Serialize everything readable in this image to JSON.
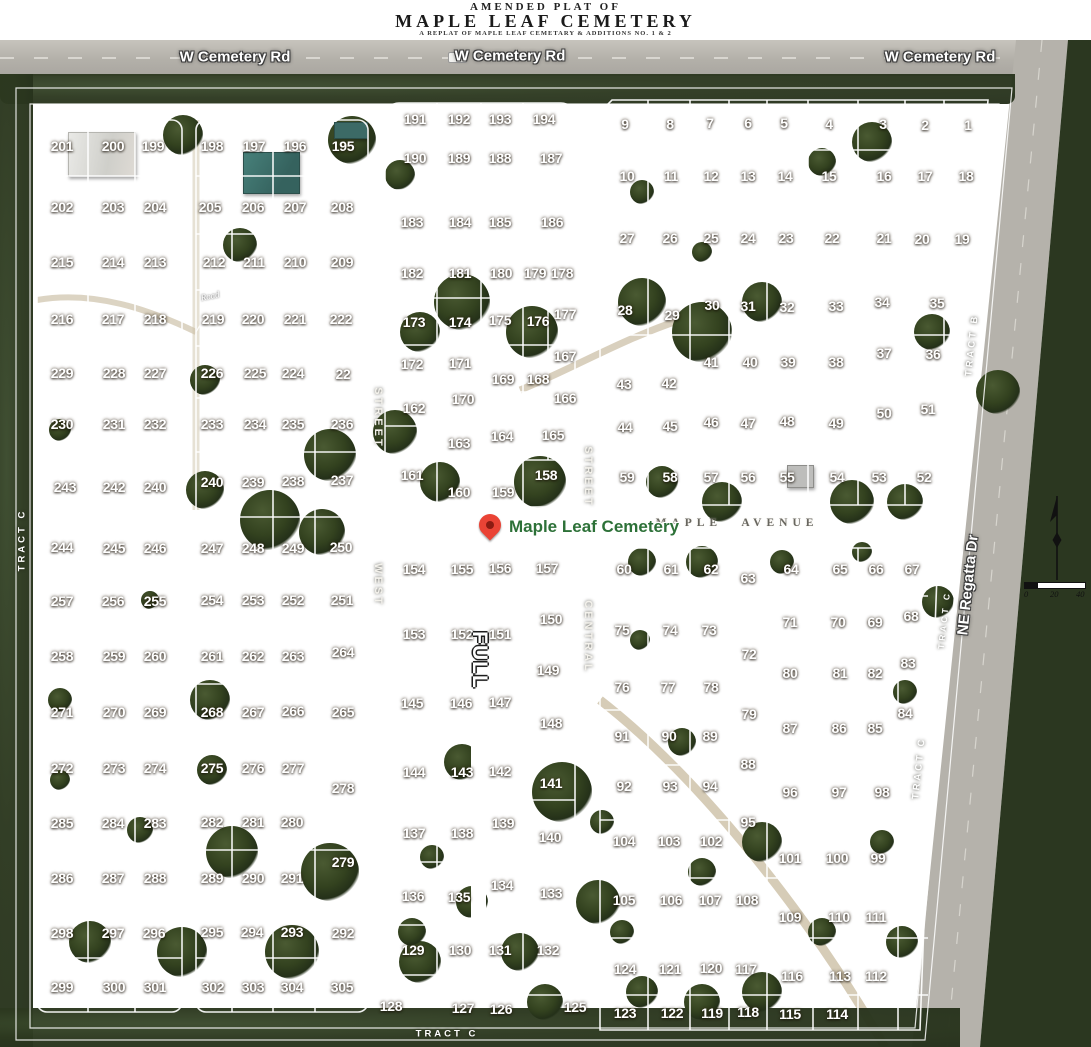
{
  "title": {
    "line1": "AMENDED PLAT OF",
    "line2": "MAPLE LEAF CEMETERY",
    "line3": "A REPLAT OF MAPLE LEAF CEMETARY & ADDITIONS NO. 1 & 2"
  },
  "roads": {
    "cemetery_rd": [
      "W Cemetery Rd",
      "W Cemetery Rd",
      "W Cemetery Rd"
    ],
    "regatta": "NE Regatta Dr",
    "road_small": "Road"
  },
  "streets": {
    "west": "WEST",
    "west_street": "STREET",
    "central": "CENTRAL",
    "central_street": "STREET",
    "full": "FULL",
    "maple_avenue": "MAPLE AVENUE"
  },
  "tracts": {
    "left": "TRACT  C",
    "bottom": "TRACT   C",
    "right_b": "TRACT  B",
    "right_c1": "TRACT  C",
    "right_c2": "TRACT  C"
  },
  "marker": {
    "label": "Maple Leaf Cemetery",
    "pin_color": "#ea4335",
    "label_color": "#2d7138"
  },
  "scale_bar": {
    "ticks": [
      "0",
      "20",
      "40"
    ]
  },
  "colors": {
    "ground": "#a08862",
    "tree": "#2c381f",
    "plat_line": "#ffffff",
    "road": "#b3b0a9"
  },
  "plots": [
    [
      201,
      62,
      146
    ],
    [
      200,
      113,
      146
    ],
    [
      199,
      153,
      146
    ],
    [
      198,
      212,
      146
    ],
    [
      197,
      254,
      146
    ],
    [
      196,
      295,
      146
    ],
    [
      195,
      343,
      146
    ],
    [
      202,
      62,
      207
    ],
    [
      203,
      113,
      207
    ],
    [
      204,
      155,
      207
    ],
    [
      205,
      210,
      207
    ],
    [
      206,
      253,
      207
    ],
    [
      207,
      295,
      207
    ],
    [
      208,
      342,
      207
    ],
    [
      215,
      62,
      262
    ],
    [
      214,
      113,
      262
    ],
    [
      213,
      155,
      262
    ],
    [
      212,
      214,
      262
    ],
    [
      211,
      254,
      262
    ],
    [
      210,
      295,
      262
    ],
    [
      209,
      342,
      262
    ],
    [
      216,
      62,
      319
    ],
    [
      217,
      113,
      319
    ],
    [
      218,
      155,
      319
    ],
    [
      219,
      213,
      319
    ],
    [
      220,
      253,
      319
    ],
    [
      221,
      295,
      319
    ],
    [
      222,
      341,
      319
    ],
    [
      229,
      62,
      373
    ],
    [
      228,
      114,
      373
    ],
    [
      227,
      155,
      373
    ],
    [
      226,
      212,
      373
    ],
    [
      225,
      255,
      373
    ],
    [
      224,
      293,
      373
    ],
    [
      22,
      343,
      374
    ],
    [
      230,
      62,
      424
    ],
    [
      231,
      114,
      424
    ],
    [
      232,
      155,
      424
    ],
    [
      233,
      212,
      424
    ],
    [
      234,
      255,
      424
    ],
    [
      235,
      293,
      424
    ],
    [
      236,
      342,
      424
    ],
    [
      243,
      65,
      487
    ],
    [
      242,
      114,
      487
    ],
    [
      240,
      155,
      487
    ],
    [
      240,
      212,
      482
    ],
    [
      239,
      253,
      482
    ],
    [
      238,
      293,
      481
    ],
    [
      237,
      342,
      480
    ],
    [
      244,
      62,
      547
    ],
    [
      245,
      114,
      548
    ],
    [
      246,
      155,
      548
    ],
    [
      247,
      212,
      548
    ],
    [
      248,
      253,
      548
    ],
    [
      249,
      293,
      548
    ],
    [
      250,
      341,
      547
    ],
    [
      257,
      62,
      601
    ],
    [
      256,
      113,
      601
    ],
    [
      255,
      155,
      601
    ],
    [
      254,
      212,
      600
    ],
    [
      253,
      253,
      600
    ],
    [
      252,
      293,
      600
    ],
    [
      251,
      342,
      600
    ],
    [
      258,
      62,
      656
    ],
    [
      259,
      114,
      656
    ],
    [
      260,
      155,
      656
    ],
    [
      261,
      212,
      656
    ],
    [
      262,
      253,
      656
    ],
    [
      263,
      293,
      656
    ],
    [
      264,
      343,
      652
    ],
    [
      271,
      62,
      712
    ],
    [
      270,
      114,
      712
    ],
    [
      269,
      155,
      712
    ],
    [
      268,
      212,
      712
    ],
    [
      267,
      253,
      712
    ],
    [
      266,
      293,
      711
    ],
    [
      265,
      343,
      712
    ],
    [
      272,
      62,
      768
    ],
    [
      273,
      114,
      768
    ],
    [
      274,
      155,
      768
    ],
    [
      275,
      212,
      768
    ],
    [
      276,
      253,
      768
    ],
    [
      277,
      293,
      768
    ],
    [
      278,
      343,
      788
    ],
    [
      285,
      62,
      823
    ],
    [
      284,
      113,
      823
    ],
    [
      283,
      155,
      823
    ],
    [
      282,
      212,
      822
    ],
    [
      281,
      253,
      822
    ],
    [
      280,
      292,
      822
    ],
    [
      279,
      343,
      862
    ],
    [
      286,
      62,
      878
    ],
    [
      287,
      113,
      878
    ],
    [
      288,
      155,
      878
    ],
    [
      289,
      212,
      878
    ],
    [
      290,
      253,
      878
    ],
    [
      291,
      292,
      878
    ],
    [
      298,
      62,
      933
    ],
    [
      297,
      113,
      933
    ],
    [
      296,
      154,
      933
    ],
    [
      295,
      212,
      932
    ],
    [
      294,
      252,
      932
    ],
    [
      293,
      292,
      932
    ],
    [
      292,
      343,
      933
    ],
    [
      299,
      62,
      987
    ],
    [
      300,
      114,
      987
    ],
    [
      301,
      155,
      987
    ],
    [
      302,
      213,
      987
    ],
    [
      303,
      253,
      987
    ],
    [
      304,
      292,
      987
    ],
    [
      305,
      342,
      987
    ],
    [
      191,
      415,
      119
    ],
    [
      192,
      459,
      119
    ],
    [
      193,
      500,
      119
    ],
    [
      194,
      544,
      119
    ],
    [
      190,
      415,
      158
    ],
    [
      189,
      459,
      158
    ],
    [
      188,
      500,
      158
    ],
    [
      187,
      551,
      158
    ],
    [
      183,
      412,
      222
    ],
    [
      184,
      460,
      222
    ],
    [
      185,
      500,
      222
    ],
    [
      186,
      552,
      222
    ],
    [
      182,
      412,
      273
    ],
    [
      181,
      460,
      273
    ],
    [
      180,
      501,
      273
    ],
    [
      179,
      535,
      273
    ],
    [
      178,
      562,
      273
    ],
    [
      173,
      414,
      322
    ],
    [
      174,
      460,
      322
    ],
    [
      175,
      500,
      320
    ],
    [
      176,
      538,
      321
    ],
    [
      177,
      565,
      314
    ],
    [
      172,
      412,
      364
    ],
    [
      171,
      460,
      363
    ],
    [
      167,
      565,
      356
    ],
    [
      169,
      503,
      379
    ],
    [
      168,
      538,
      379
    ],
    [
      170,
      463,
      399
    ],
    [
      166,
      565,
      398
    ],
    [
      162,
      414,
      408
    ],
    [
      163,
      459,
      443
    ],
    [
      164,
      502,
      436
    ],
    [
      165,
      553,
      435
    ],
    [
      161,
      412,
      475
    ],
    [
      158,
      546,
      475
    ],
    [
      160,
      459,
      492
    ],
    [
      159,
      503,
      492
    ],
    [
      9,
      625,
      124
    ],
    [
      8,
      670,
      124
    ],
    [
      7,
      710,
      123
    ],
    [
      6,
      748,
      123
    ],
    [
      5,
      784,
      123
    ],
    [
      4,
      829,
      124
    ],
    [
      3,
      883,
      124
    ],
    [
      2,
      925,
      125
    ],
    [
      1,
      968,
      125
    ],
    [
      10,
      627,
      176
    ],
    [
      11,
      671,
      176
    ],
    [
      12,
      711,
      176
    ],
    [
      13,
      748,
      176
    ],
    [
      14,
      785,
      176
    ],
    [
      15,
      829,
      176
    ],
    [
      16,
      884,
      176
    ],
    [
      17,
      925,
      176
    ],
    [
      18,
      966,
      176
    ],
    [
      27,
      627,
      238
    ],
    [
      26,
      670,
      238
    ],
    [
      25,
      711,
      238
    ],
    [
      24,
      748,
      238
    ],
    [
      23,
      786,
      238
    ],
    [
      22,
      832,
      238
    ],
    [
      21,
      884,
      238
    ],
    [
      20,
      922,
      239
    ],
    [
      19,
      962,
      239
    ],
    [
      28,
      625,
      310
    ],
    [
      29,
      672,
      315
    ],
    [
      30,
      712,
      305
    ],
    [
      31,
      748,
      306
    ],
    [
      32,
      787,
      307
    ],
    [
      33,
      836,
      306
    ],
    [
      34,
      882,
      302
    ],
    [
      35,
      937,
      303
    ],
    [
      43,
      624,
      384
    ],
    [
      42,
      669,
      383
    ],
    [
      41,
      711,
      362
    ],
    [
      40,
      750,
      362
    ],
    [
      39,
      788,
      362
    ],
    [
      38,
      836,
      362
    ],
    [
      37,
      884,
      353
    ],
    [
      36,
      933,
      354
    ],
    [
      44,
      625,
      427
    ],
    [
      45,
      670,
      426
    ],
    [
      46,
      711,
      422
    ],
    [
      47,
      748,
      423
    ],
    [
      48,
      787,
      421
    ],
    [
      49,
      836,
      423
    ],
    [
      50,
      884,
      413
    ],
    [
      51,
      928,
      409
    ],
    [
      59,
      627,
      477
    ],
    [
      58,
      670,
      477
    ],
    [
      57,
      711,
      477
    ],
    [
      56,
      748,
      477
    ],
    [
      55,
      787,
      477
    ],
    [
      54,
      837,
      477
    ],
    [
      53,
      879,
      477
    ],
    [
      52,
      924,
      477
    ],
    [
      154,
      414,
      569
    ],
    [
      155,
      462,
      569
    ],
    [
      156,
      500,
      568
    ],
    [
      157,
      547,
      568
    ],
    [
      150,
      551,
      619
    ],
    [
      153,
      414,
      634
    ],
    [
      152,
      462,
      634
    ],
    [
      151,
      500,
      634
    ],
    [
      149,
      548,
      670
    ],
    [
      145,
      412,
      703
    ],
    [
      146,
      461,
      703
    ],
    [
      147,
      500,
      702
    ],
    [
      148,
      551,
      723
    ],
    [
      144,
      414,
      772
    ],
    [
      143,
      462,
      772
    ],
    [
      142,
      500,
      771
    ],
    [
      141,
      551,
      783
    ],
    [
      137,
      414,
      833
    ],
    [
      138,
      462,
      833
    ],
    [
      139,
      503,
      823
    ],
    [
      140,
      550,
      837
    ],
    [
      136,
      413,
      896
    ],
    [
      135,
      459,
      897
    ],
    [
      134,
      502,
      885
    ],
    [
      133,
      551,
      893
    ],
    [
      129,
      413,
      950
    ],
    [
      130,
      460,
      950
    ],
    [
      131,
      500,
      950
    ],
    [
      132,
      548,
      950
    ],
    [
      128,
      391,
      1006
    ],
    [
      127,
      463,
      1008
    ],
    [
      126,
      501,
      1009
    ],
    [
      125,
      575,
      1007
    ],
    [
      60,
      624,
      569
    ],
    [
      61,
      671,
      569
    ],
    [
      62,
      711,
      569
    ],
    [
      63,
      748,
      578
    ],
    [
      64,
      791,
      569
    ],
    [
      65,
      840,
      569
    ],
    [
      66,
      876,
      569
    ],
    [
      67,
      912,
      569
    ],
    [
      75,
      622,
      630
    ],
    [
      74,
      670,
      630
    ],
    [
      73,
      709,
      630
    ],
    [
      71,
      790,
      622
    ],
    [
      70,
      838,
      622
    ],
    [
      69,
      875,
      622
    ],
    [
      68,
      911,
      616
    ],
    [
      72,
      749,
      654
    ],
    [
      76,
      622,
      687
    ],
    [
      77,
      668,
      687
    ],
    [
      78,
      711,
      687
    ],
    [
      80,
      790,
      673
    ],
    [
      81,
      840,
      673
    ],
    [
      82,
      875,
      673
    ],
    [
      83,
      908,
      663
    ],
    [
      79,
      749,
      714
    ],
    [
      91,
      622,
      736
    ],
    [
      90,
      669,
      736
    ],
    [
      89,
      710,
      736
    ],
    [
      87,
      790,
      728
    ],
    [
      86,
      839,
      728
    ],
    [
      85,
      875,
      728
    ],
    [
      84,
      905,
      713
    ],
    [
      88,
      748,
      764
    ],
    [
      92,
      624,
      786
    ],
    [
      93,
      670,
      786
    ],
    [
      94,
      710,
      786
    ],
    [
      96,
      790,
      792
    ],
    [
      97,
      839,
      792
    ],
    [
      98,
      882,
      792
    ],
    [
      95,
      748,
      822
    ],
    [
      104,
      624,
      841
    ],
    [
      103,
      669,
      841
    ],
    [
      102,
      711,
      841
    ],
    [
      101,
      790,
      858
    ],
    [
      100,
      837,
      858
    ],
    [
      99,
      878,
      858
    ],
    [
      105,
      624,
      900
    ],
    [
      106,
      671,
      900
    ],
    [
      107,
      710,
      900
    ],
    [
      108,
      747,
      900
    ],
    [
      109,
      790,
      917
    ],
    [
      110,
      839,
      917
    ],
    [
      111,
      876,
      917
    ],
    [
      124,
      625,
      969
    ],
    [
      121,
      670,
      969
    ],
    [
      120,
      711,
      968
    ],
    [
      117,
      746,
      969
    ],
    [
      116,
      792,
      976
    ],
    [
      113,
      840,
      976
    ],
    [
      112,
      876,
      976
    ],
    [
      123,
      625,
      1013
    ],
    [
      122,
      672,
      1013
    ],
    [
      119,
      712,
      1013
    ],
    [
      118,
      748,
      1012
    ],
    [
      115,
      790,
      1014
    ],
    [
      114,
      837,
      1014
    ]
  ]
}
